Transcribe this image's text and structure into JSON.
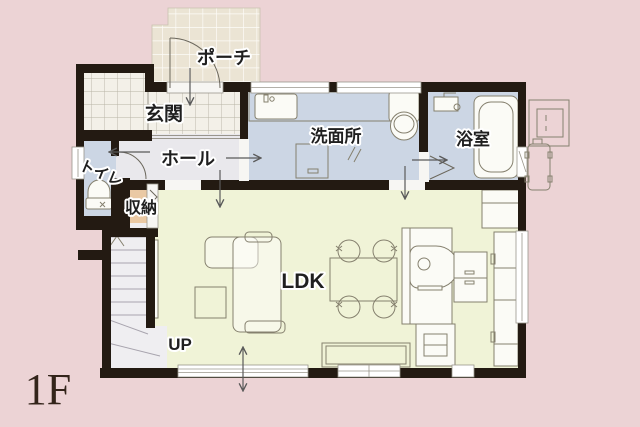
{
  "floor_plan": {
    "floor_label": "1F",
    "rooms": {
      "porch": {
        "label": "ポーチ"
      },
      "entrance": {
        "label": "玄関"
      },
      "hall": {
        "label": "ホール"
      },
      "toilet": {
        "label": "トイレ"
      },
      "storage": {
        "label": "収納"
      },
      "washroom": {
        "label": "洗面所"
      },
      "bathroom": {
        "label": "浴室"
      },
      "ldk": {
        "label": "LDK"
      },
      "stairs": {
        "label": "UP"
      }
    },
    "colors": {
      "background": "#ecd3d5",
      "wall": "#231a12",
      "wet_room_floor": "#ccd6e4",
      "hall_floor": "#e9e8ec",
      "ldk_floor": "#f0f3d7",
      "storage_floor": "#eac9a4",
      "stairs_floor": "#efeef1",
      "porch_tile": "#ebe4d4",
      "entrance_tile": "#f3f0e8",
      "window_fill": "#ffffff",
      "opening_fill": "#f7f6f3",
      "label_text": "#1f1f1f",
      "floor_label_text": "#33241a",
      "furniture_line": "#85806e",
      "arrow": "#5a5a5a"
    },
    "fixtures": [
      "front-door-swing",
      "toilet-fixture",
      "hand-basin",
      "vanity-sink",
      "washing-machine",
      "laundry-cabinet",
      "bathtub",
      "shower-mixer",
      "kitchen-island-sink",
      "stove-cart",
      "refrigerator",
      "pantry-cabinet",
      "dining-table",
      "dining-chair",
      "sofa",
      "coffee-table",
      "tv-board",
      "staircase-up",
      "handrail",
      "water-heater",
      "ac-outdoor-unit",
      "flow-arrow"
    ]
  }
}
